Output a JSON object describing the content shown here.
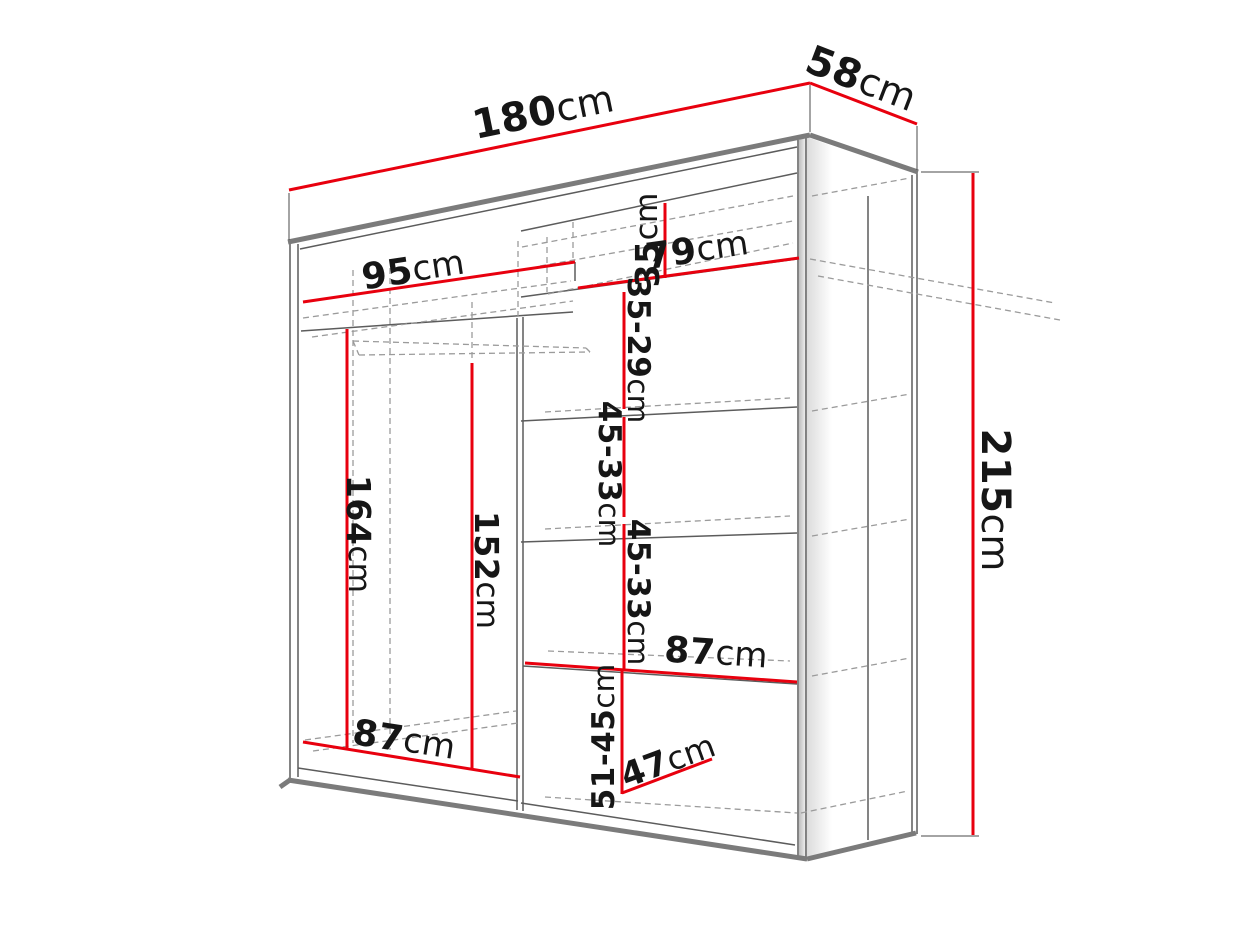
{
  "figure": {
    "type": "technical-dimension-drawing",
    "subject": "sliding-door wardrobe shown in perspective with internal shelf dimensions",
    "units": "cm",
    "background": "#ffffff"
  },
  "measurements": {
    "overall_width": "180cm",
    "overall_depth": "58cm",
    "overall_height": "215cm",
    "top_left_section_width": "95cm",
    "top_right_section_width": "79cm",
    "top_shelf_height": "35cm",
    "upper_right_gap": "35-29cm",
    "mid_right_gaps": [
      "45-33cm",
      "45-33cm"
    ],
    "left_hanging_height": "164cm",
    "left_clear_height": "152cm",
    "right_lower_shelf_width": "87cm",
    "left_bottom_width": "87cm",
    "bottom_right_gap": "51-45cm",
    "bottom_shelf_depth": "47cm"
  },
  "colors": {
    "dimension_red": "#e8000e",
    "structure_grey": "#7b7b7b",
    "edge_grey": "#5c5c5c",
    "hidden_grey": "#9b9b9b",
    "text_black": "#161616"
  },
  "diagram": {
    "red_lines": [
      {
        "name": "dim-line-width-180",
        "p": [
          289,
          190,
          810,
          83
        ]
      },
      {
        "name": "dim-line-depth-58",
        "p": [
          810,
          83,
          917,
          124
        ]
      },
      {
        "name": "dim-line-height-215",
        "p": [
          973,
          173,
          973,
          835
        ]
      },
      {
        "name": "dim-line-95",
        "p": [
          303,
          302,
          575,
          262
        ]
      },
      {
        "name": "dim-line-79",
        "p": [
          578,
          288,
          799,
          258
        ]
      },
      {
        "name": "dim-line-35",
        "p": [
          665,
          203,
          665,
          278
        ]
      },
      {
        "name": "dim-line-35-29",
        "p": [
          624,
          292,
          624,
          409
        ]
      },
      {
        "name": "dim-line-45-33-a",
        "p": [
          624,
          417,
          624,
          517
        ]
      },
      {
        "name": "dim-line-45-33-b",
        "p": [
          624,
          524,
          624,
          669
        ]
      },
      {
        "name": "dim-line-51-45",
        "p": [
          622,
          671,
          622,
          794
        ]
      },
      {
        "name": "dim-line-47",
        "p": [
          622,
          793,
          712,
          759
        ]
      },
      {
        "name": "dim-line-87-right",
        "p": [
          525,
          663,
          797,
          682
        ]
      },
      {
        "name": "dim-line-87-left",
        "p": [
          303,
          742,
          520,
          777
        ]
      },
      {
        "name": "dim-line-164",
        "p": [
          347,
          329,
          347,
          749
        ]
      },
      {
        "name": "dim-line-152",
        "p": [
          472,
          363,
          472,
          768
        ]
      }
    ],
    "leader_lines": [
      {
        "name": "leader-180-left",
        "p": [
          289,
          193,
          289,
          240
        ]
      },
      {
        "name": "leader-180-right",
        "p": [
          810,
          85,
          810,
          132
        ]
      },
      {
        "name": "leader-58-right",
        "p": [
          917,
          126,
          917,
          170
        ]
      },
      {
        "name": "leader-215-top",
        "p": [
          921,
          172,
          979,
          172
        ]
      },
      {
        "name": "leader-215-bottom",
        "p": [
          921,
          836,
          979,
          836
        ]
      }
    ],
    "thick_lines": [
      {
        "name": "front-top-edge",
        "p": [
          288,
          242,
          810,
          135
        ]
      },
      {
        "name": "side-top-edge",
        "p": [
          810,
          135,
          918,
          172
        ]
      },
      {
        "name": "front-bottom-edge",
        "p": [
          288,
          780,
          807,
          859
        ]
      },
      {
        "name": "side-bottom-edge",
        "p": [
          807,
          859,
          916,
          833
        ]
      },
      {
        "name": "plinth-step",
        "p": [
          280,
          787,
          290,
          780
        ]
      }
    ],
    "thin_lines": [
      {
        "name": "left-edge-outer",
        "p": [
          290,
          242,
          290,
          779
        ]
      },
      {
        "name": "left-edge-inner",
        "p": [
          298,
          244,
          298,
          777
        ]
      },
      {
        "name": "right-stile-inner",
        "p": [
          798,
          140,
          798,
          859
        ]
      },
      {
        "name": "right-stile-outer",
        "p": [
          806,
          136,
          806,
          861
        ]
      },
      {
        "name": "side-right-edge-inner",
        "p": [
          912,
          175,
          912,
          832
        ]
      },
      {
        "name": "side-right-edge-outer",
        "p": [
          917,
          172,
          917,
          834
        ]
      },
      {
        "name": "side-back-line",
        "p": [
          868,
          196,
          868,
          840
        ]
      },
      {
        "name": "interior-ceiling",
        "p": [
          300,
          249,
          797,
          147
        ]
      },
      {
        "name": "left-top-shelf",
        "p": [
          301,
          331,
          573,
          312
        ]
      },
      {
        "name": "right-shelf-a",
        "p": [
          521,
          231,
          797,
          173
        ]
      },
      {
        "name": "right-shelf-b",
        "p": [
          521,
          297,
          797,
          259
        ]
      },
      {
        "name": "right-shelf-c",
        "p": [
          521,
          421,
          797,
          407
        ]
      },
      {
        "name": "right-shelf-d",
        "p": [
          521,
          542,
          797,
          533
        ]
      },
      {
        "name": "right-shelf-e",
        "p": [
          523,
          666,
          797,
          684
        ]
      },
      {
        "name": "floor-left",
        "p": [
          298,
          768,
          518,
          801
        ]
      },
      {
        "name": "floor-right",
        "p": [
          521,
          803,
          795,
          845
        ]
      },
      {
        "name": "divider-left",
        "p": [
          517,
          318,
          517,
          810
        ]
      },
      {
        "name": "divider-right",
        "p": [
          523,
          317,
          523,
          811
        ]
      },
      {
        "name": "partition-stub",
        "p": [
          575,
          262,
          575,
          281
        ]
      }
    ],
    "dashed_lines": [
      {
        "name": "left-shelf-back-1",
        "p": [
          303,
          318,
          571,
          281
        ]
      },
      {
        "name": "left-shelf-back-2",
        "p": [
          312,
          337,
          573,
          301
        ]
      },
      {
        "name": "top-row-back-1",
        "p": [
          522,
          247,
          793,
          196
        ]
      },
      {
        "name": "top-row-back-2",
        "p": [
          540,
          266,
          793,
          221
        ]
      },
      {
        "name": "shelf-b-back",
        "p": [
          548,
          294,
          793,
          243
        ]
      },
      {
        "name": "shelf-c-back",
        "p": [
          545,
          412,
          790,
          398
        ]
      },
      {
        "name": "shelf-d-back",
        "p": [
          545,
          529,
          790,
          516
        ]
      },
      {
        "name": "shelf-e-back",
        "p": [
          548,
          651,
          790,
          661
        ]
      },
      {
        "name": "floor-back-left-1",
        "p": [
          305,
          740,
          516,
          711
        ]
      },
      {
        "name": "floor-back-left-2",
        "p": [
          313,
          751,
          518,
          723
        ]
      },
      {
        "name": "floor-back-right",
        "p": [
          545,
          797,
          797,
          813
        ]
      },
      {
        "name": "hanging-rail-front",
        "p": [
          353,
          341,
          586,
          348
        ]
      },
      {
        "name": "hanging-rail-back",
        "p": [
          359,
          355,
          590,
          352
        ]
      },
      {
        "name": "hanging-rail-end-left",
        "p": [
          353,
          341,
          359,
          355
        ]
      },
      {
        "name": "hanging-rail-end-right",
        "p": [
          586,
          348,
          590,
          352
        ]
      },
      {
        "name": "hidden-vertical-1",
        "p": [
          353,
          270,
          353,
          743
        ]
      },
      {
        "name": "hidden-vertical-2",
        "p": [
          390,
          268,
          390,
          750
        ]
      },
      {
        "name": "hidden-vertical-3",
        "p": [
          472,
          302,
          472,
          360
        ]
      },
      {
        "name": "divider-hidden-top",
        "p": [
          518,
          241,
          518,
          316
        ]
      },
      {
        "name": "partition-hidden-top",
        "p": [
          573,
          222,
          573,
          260
        ]
      },
      {
        "name": "partition-hidden-back",
        "p": [
          547,
          237,
          547,
          292
        ]
      },
      {
        "name": "side-ceiling-back",
        "p": [
          812,
          196,
          910,
          178
        ]
      },
      {
        "name": "side-shelf-c-back",
        "p": [
          812,
          411,
          910,
          394
        ]
      },
      {
        "name": "side-shelf-d-back",
        "p": [
          812,
          536,
          910,
          519
        ]
      },
      {
        "name": "side-shelf-e-back",
        "p": [
          812,
          676,
          910,
          658
        ]
      },
      {
        "name": "side-floor-back",
        "p": [
          801,
          813,
          908,
          791
        ]
      },
      {
        "name": "top-shelf-projection-1",
        "p": [
          810,
          259,
          1055,
          303
        ]
      },
      {
        "name": "top-shelf-projection-2",
        "p": [
          818,
          276,
          1060,
          320
        ]
      }
    ],
    "labels": [
      {
        "name": "label-180cm",
        "n": "180",
        "u": "cm",
        "x": 543,
        "y": 112,
        "rot": -11.5,
        "size": 40
      },
      {
        "name": "label-58cm",
        "n": "58",
        "u": "cm",
        "x": 861,
        "y": 79,
        "rot": 21,
        "size": 40
      },
      {
        "name": "label-215cm",
        "n": "215",
        "u": "cm",
        "x": 995,
        "y": 500,
        "rot": 90,
        "size": 40
      },
      {
        "name": "label-95cm",
        "n": "95",
        "u": "cm",
        "x": 413,
        "y": 270,
        "rot": -8.5,
        "size": 36
      },
      {
        "name": "label-79cm",
        "n": "79",
        "u": "cm",
        "x": 697,
        "y": 250,
        "rot": -8,
        "size": 36
      },
      {
        "name": "label-35cm",
        "n": "35",
        "u": "cm",
        "x": 647,
        "y": 240,
        "rot": -90,
        "size": 33
      },
      {
        "name": "label-35-29cm",
        "n": "35-29",
        "u": "cm",
        "x": 638,
        "y": 350,
        "rot": 90,
        "size": 31
      },
      {
        "name": "label-45-33cm-a",
        "n": "45-33",
        "u": "cm",
        "x": 609,
        "y": 474,
        "rot": 90,
        "size": 31
      },
      {
        "name": "label-45-33cm-b",
        "n": "45-33",
        "u": "cm",
        "x": 638,
        "y": 592,
        "rot": 90,
        "size": 31
      },
      {
        "name": "label-51-45cm",
        "n": "51-45",
        "u": "cm",
        "x": 604,
        "y": 737,
        "rot": -90,
        "size": 31
      },
      {
        "name": "label-87cm-right",
        "n": "87",
        "u": "cm",
        "x": 716,
        "y": 653,
        "rot": 4,
        "size": 36
      },
      {
        "name": "label-87cm-left",
        "n": "87",
        "u": "cm",
        "x": 404,
        "y": 740,
        "rot": 9,
        "size": 36
      },
      {
        "name": "label-47cm",
        "n": "47",
        "u": "cm",
        "x": 668,
        "y": 761,
        "rot": -20,
        "size": 34
      },
      {
        "name": "label-164cm",
        "n": "164",
        "u": "cm",
        "x": 359,
        "y": 534,
        "rot": 90,
        "size": 33
      },
      {
        "name": "label-152cm",
        "n": "152",
        "u": "cm",
        "x": 487,
        "y": 570,
        "rot": 90,
        "size": 33
      }
    ]
  }
}
